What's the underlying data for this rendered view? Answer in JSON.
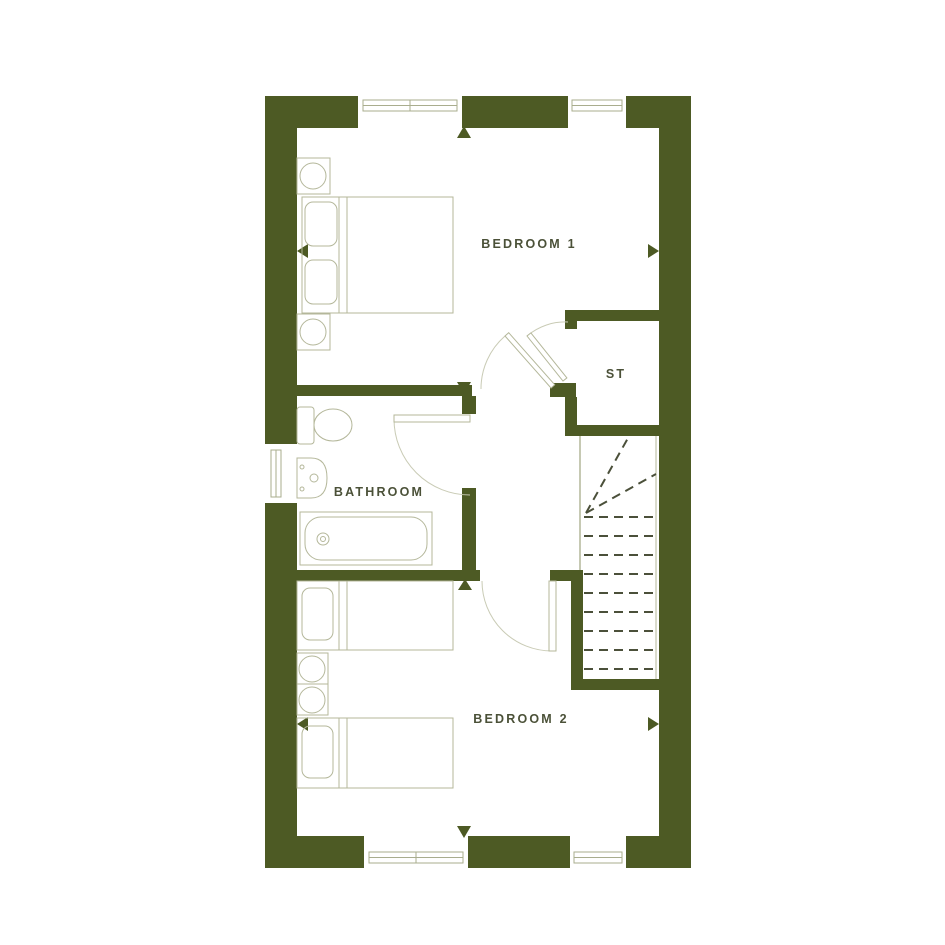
{
  "labels": {
    "bedroom1": "BEDROOM 1",
    "storage": "ST",
    "bathroom": "BATHROOM",
    "bedroom2": "BEDROOM 2"
  },
  "colors": {
    "wall": "#4d5a24",
    "furniture-line": "#b4b79a",
    "door-line": "#c9cbb5",
    "stair-dash": "#4b503a",
    "label-text": "#4b5138",
    "window-frame": "#a9ad8e",
    "background": "#ffffff"
  }
}
